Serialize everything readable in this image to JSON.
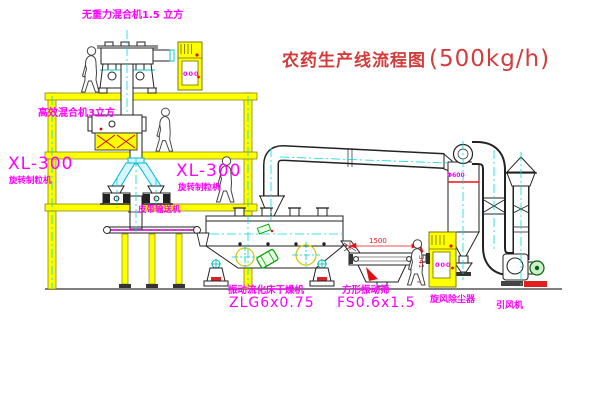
{
  "title": {
    "text": "农药生产线流程图",
    "capacity": "(500kg/h)"
  },
  "labels": {
    "gravity_mixer": "无重力混合机1.5 立方",
    "high_eff_mixer": "高效混合机3立方",
    "granulator_left_model": "XL-300",
    "granulator_left_name": "旋转制粒机",
    "granulator_right_model": "XL-300",
    "granulator_right_name": "旋转制粒机",
    "belt_conveyor": "皮带输送机",
    "dryer_name": "振动流化床干燥机",
    "dryer_model": "ZLG6x0.75",
    "screen_name": "方形振动筛",
    "screen_model": "FS0.6x1.5",
    "cyclone": "旋风除尘器",
    "fan": "引风机"
  },
  "dimensions": {
    "screen_length": "1500",
    "screen_height": "341",
    "cyclone_mark": "Φ600"
  },
  "cabinets": {
    "display_text": "000"
  },
  "colors": {
    "structure_yellow": "#ffff00",
    "centerline_cyan": "#00dddd",
    "label_magenta": "#ff00ff",
    "title_red": "#d43c3c",
    "dimension_red": "#ee1111",
    "valve_green": "#00a000"
  }
}
